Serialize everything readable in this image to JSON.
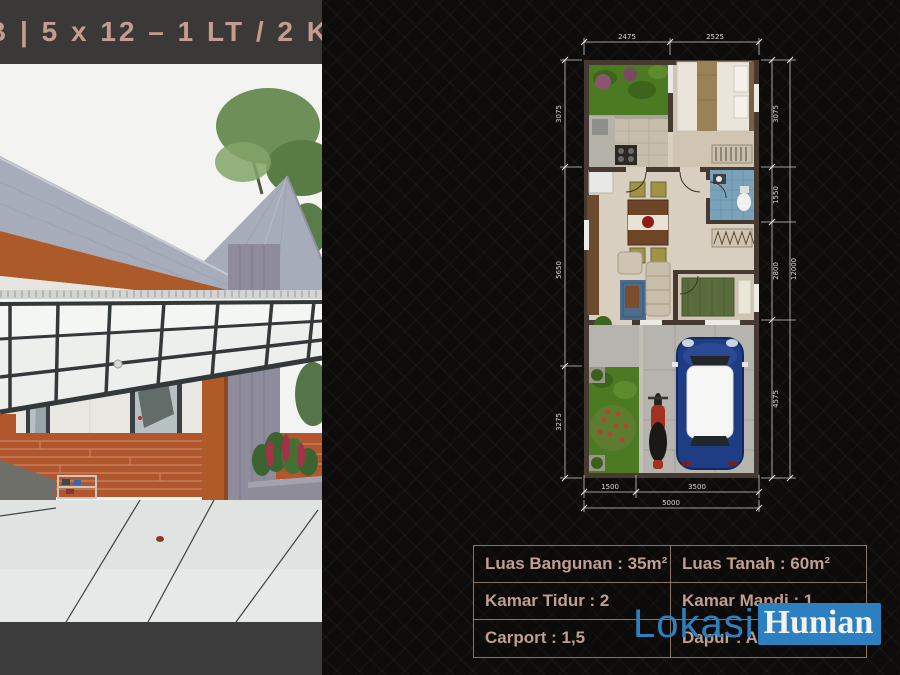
{
  "title_bar": {
    "text": "B | 5 x 12 – 1 LT / 2 KT"
  },
  "floor_plan": {
    "dim_top": [
      "2475",
      "2525"
    ],
    "dim_left": [
      "3075",
      "5650",
      "3275"
    ],
    "dim_right": [
      "3075",
      "1550",
      "2800",
      "4575"
    ],
    "dim_right_total": "12000",
    "dim_bottom": [
      "1500",
      "3500"
    ],
    "dim_bottom_total": "5000"
  },
  "spec_table": {
    "rows": [
      {
        "left": "Luas Bangunan : 35m²",
        "right": "Luas Tanah : 60m²"
      },
      {
        "left": "Kamar Tidur : 2",
        "right": "Kamar Mandi : 1"
      },
      {
        "left": "Carport : 1,5",
        "right": "Dapur : Ada"
      }
    ]
  },
  "watermark": {
    "first": "Lokasi",
    "second": "Hunian"
  },
  "colors": {
    "accent_blue": "#2d7fc0",
    "title_text": "#c69c90",
    "table_text": "#c09e92",
    "table_border": "#8a7464",
    "bar_bg": "#3b3937",
    "background": "#0d0c0a"
  }
}
